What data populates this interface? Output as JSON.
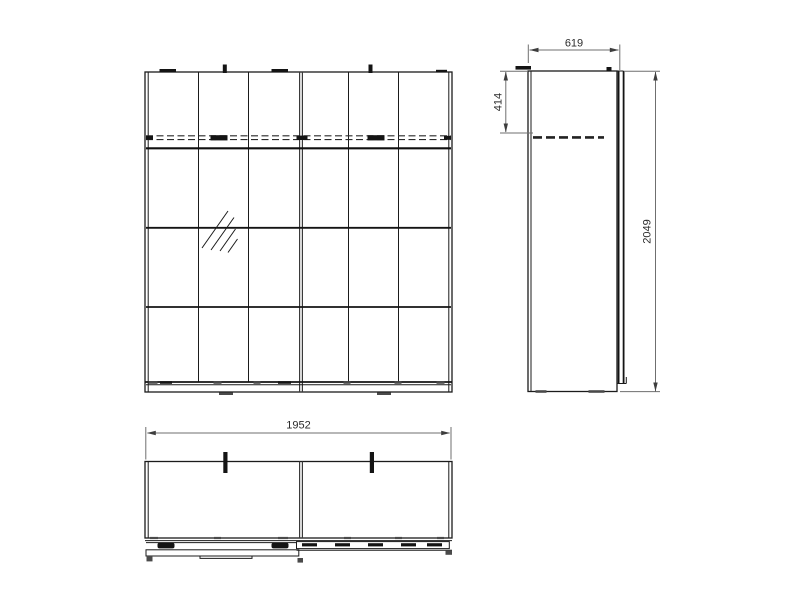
{
  "drawing": {
    "type": "furniture-technical-drawing",
    "subject": "sliding-door wardrobe with mirror, three orthographic views",
    "colors": {
      "line": "#1b1b1b",
      "dimension_line": "#6f6f6f",
      "background": "#ffffff"
    },
    "dimensions": {
      "plan_width": "1952",
      "side_depth": "619",
      "side_height": "2049",
      "rail_offset": "414"
    }
  }
}
